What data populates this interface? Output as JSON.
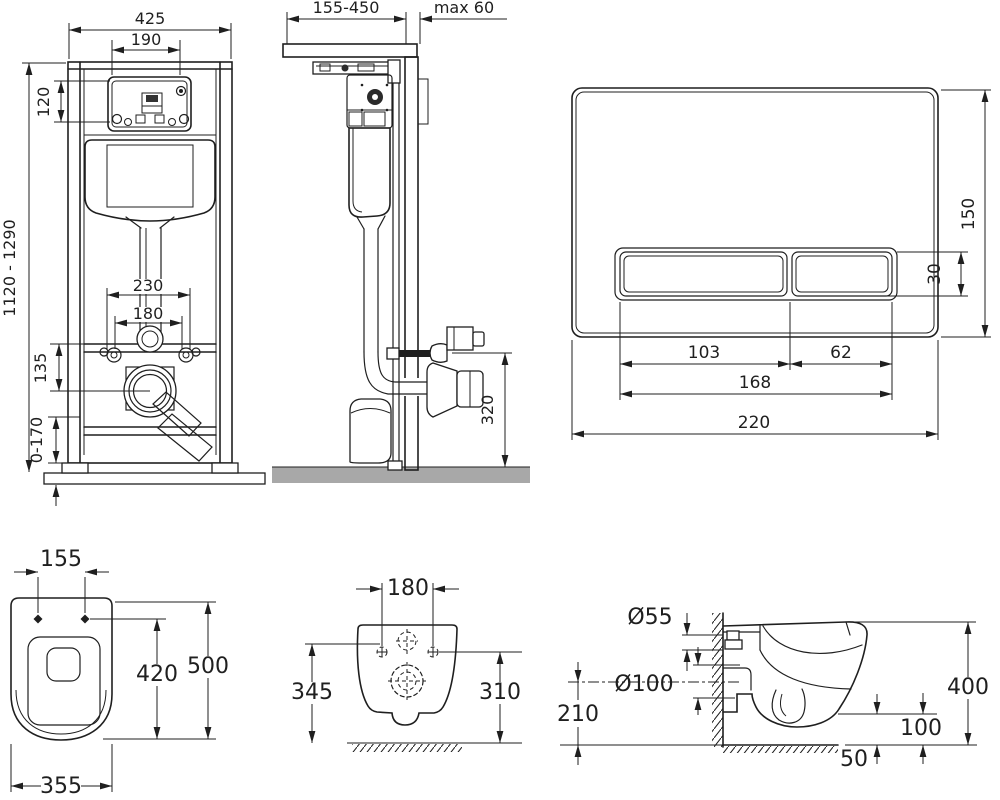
{
  "colors": {
    "line": "#1f1f1f",
    "wall_gray": "#9c9c9c",
    "bracket_gray": "#4a4a4a",
    "floor_gray": "#a8a8a8",
    "background": "#ffffff"
  },
  "views": {
    "frame_front": {
      "dims": {
        "width": "425",
        "service_opening_width": "190",
        "service_opening_height": "120",
        "height": "1120 - 1290",
        "fixing_span": "230",
        "drain_span": "180",
        "drain_offset": "135",
        "feet_adjustment": "0-170"
      }
    },
    "frame_side": {
      "dims": {
        "depth_range": "155-450",
        "wall_max": "max 60",
        "outlet_height": "320"
      }
    },
    "flush_plate": {
      "dims": {
        "height": "150",
        "button_height": "30",
        "left_button_width": "103",
        "right_button_width": "62",
        "buttons_width": "168",
        "width": "220"
      }
    },
    "bowl_top": {
      "dims": {
        "fixing_span": "155",
        "length_total": "500",
        "length_inner": "420",
        "width": "355"
      }
    },
    "bowl_rear": {
      "dims": {
        "fixing_span": "180",
        "height_left": "345",
        "height_right": "310"
      }
    },
    "bowl_side": {
      "dims": {
        "inlet_diameter": "Ø55",
        "outlet_diameter": "Ø100",
        "outlet_center_height": "210",
        "height": "400",
        "underside_height": "100",
        "wall_offset": "50"
      }
    }
  }
}
